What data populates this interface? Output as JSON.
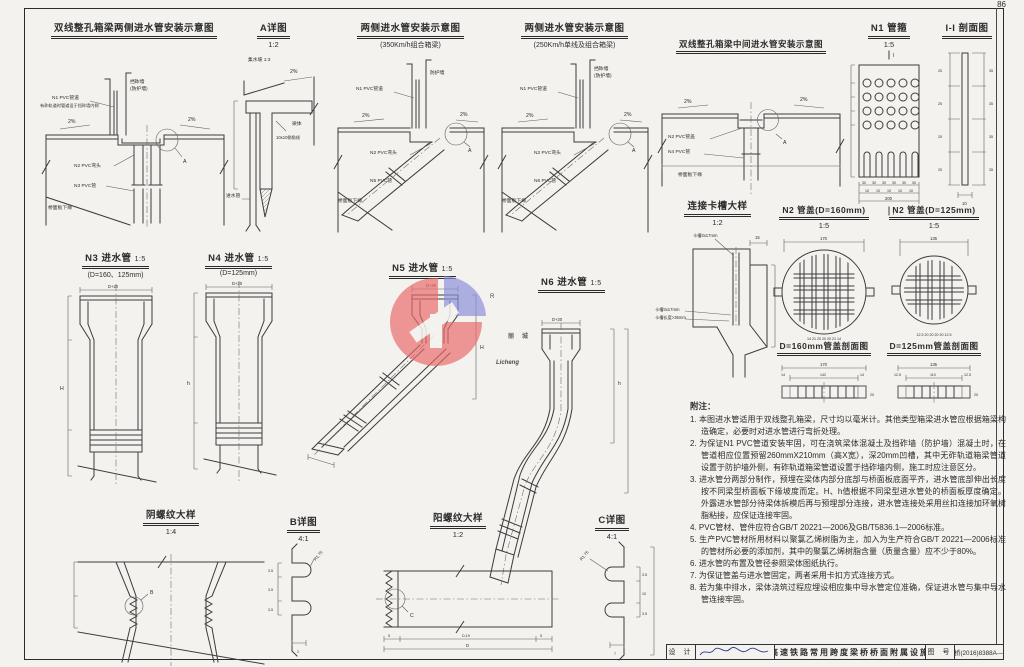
{
  "page": {
    "number": "86"
  },
  "watermark": {
    "cn": "丽城",
    "en": "Licheng",
    "reg": "R"
  },
  "d1": {
    "title": "双线整孔箱梁两侧进水管安装示意图",
    "wall1": "挡砟墙",
    "wall2": "(防护墙)",
    "n1": "N1 PVC管道",
    "n1sub": "有砟轨道时管道设于挡砟墙内侧",
    "slope": "2%",
    "n2": "N2 PVC弯头",
    "n3": "N3 PVC管",
    "deck": "桥面板下缘",
    "detail": "A"
  },
  "d2": {
    "title": "A详图",
    "scale": "1:2",
    "catch": "集水坡 1:3",
    "slope": "2%",
    "body": "梁体",
    "chamfer": "10x10倒角线",
    "inlet": "进水管"
  },
  "d3": {
    "title": "两侧进水管安装示意图",
    "sub": "(350Km/h组合箱梁)",
    "wall": "防护墙",
    "n1": "N1 PVC管道",
    "slope": "2%",
    "n2": "N2 PVC弯头",
    "n5": "N5 PVC管",
    "deck": "桥面板下缘",
    "detail": "A"
  },
  "d4": {
    "title": "两侧进水管安装示意图",
    "sub": "(250Km/h单线及组合箱梁)",
    "wall1": "挡砟墙",
    "wall2": "(防护墙)",
    "n1": "N1 PVC管道",
    "slope": "2%",
    "n2": "N2 PVC弯头",
    "n6": "N6 PVC管",
    "deck": "桥面板下缘",
    "detail": "A"
  },
  "d5": {
    "title": "双线整孔箱梁中间进水管安装示意图",
    "slope": "2%",
    "n2": "N2 PVC管盖",
    "n4": "N4 PVC管",
    "deck": "桥面板下缘",
    "detail": "A"
  },
  "d6": {
    "title": "N1 管箍",
    "scale": "1:5",
    "sect": "I",
    "dims_bottom": [
      "30",
      "30",
      "30",
      "30",
      "30",
      "30"
    ],
    "dims_small": [
      "10",
      "10",
      "10",
      "10",
      "10"
    ],
    "total": "200"
  },
  "d7": {
    "title": "I-I 剖面图",
    "dims_left": [
      "25",
      "25",
      "25",
      "25"
    ],
    "dims_right": [
      "35",
      "35",
      "35",
      "35"
    ],
    "dim_bottom": "10"
  },
  "d8": {
    "title": "连接卡槽大样",
    "scale": "1:2",
    "slot1": "卡槽3x17mm",
    "slot2": "卡槽3x17mm",
    "slot3": "卡槽长度>35mm",
    "dim_top": "15"
  },
  "d9": {
    "title": "N2 管盖(D=160mm)",
    "scale": "1:5",
    "dim": "170",
    "dims_bottom": "14 21 20 20 20 21 14"
  },
  "d10": {
    "title": "N2 管盖(D=125mm)",
    "scale": "1:5",
    "dim": "135",
    "dims_bottom": "12.5 20 20 20 20 12.5"
  },
  "d11": {
    "title": "D=160mm管盖剖面图",
    "total": "170",
    "inner": "142",
    "edge": "14",
    "side": "20"
  },
  "d12": {
    "title": "D=125mm管盖剖面图",
    "total": "135",
    "inner": "110",
    "edge": "12.5",
    "side": "20"
  },
  "d13": {
    "title": "N3 进水管",
    "scale": "1:5",
    "sub": "(D=160、125mm)",
    "dim_top": "D+20",
    "dim_h": "H"
  },
  "d14": {
    "title": "N4 进水管",
    "scale": "1:5",
    "sub": "(D=125mm)",
    "dim_top": "D+20",
    "dim_h": "h"
  },
  "d15": {
    "title": "N5 进水管",
    "scale": "1:5",
    "dim_top": "D+20",
    "dim_h": "H"
  },
  "d16": {
    "title": "N6 进水管",
    "scale": "1:5",
    "dim_top": "D+20",
    "dim_h": "h"
  },
  "d17": {
    "title": "阴螺纹大样",
    "scale": "1:4",
    "detail": "B"
  },
  "d18": {
    "title": "B详图",
    "scale": "4:1",
    "r": "R1.75",
    "dims": [
      "3.5",
      "3.5",
      "3.5"
    ],
    "b": "2"
  },
  "d19": {
    "title": "阳螺纹大样",
    "scale": "1:2",
    "detail": "C",
    "dims": {
      "end1": "5",
      "mid": "D-19",
      "end2": "5",
      "total": "D"
    }
  },
  "d20": {
    "title": "C详图",
    "scale": "4:1",
    "r": "R1.75",
    "dims": [
      "3.5",
      "10",
      "3.5"
    ],
    "b": "7"
  },
  "notes": {
    "title": "附注：",
    "items": [
      "1. 本图进水管适用于双线整孔箱梁，尺寸均以毫米计。其他类型箱梁进水管应根据箱梁构造确定，必要时对进水管进行弯折处理。",
      "2. 为保证N1 PVC管道安装牢固，可在浇筑梁体混凝土及挡砟墙（防护墙）混凝土时，在管道相应位置预留260mmX210mm（高X宽），深20mm凹槽，其中无砟轨道箱梁管道设置于防护墙外侧，有砟轨道箱梁管道设置于挡砟墙内侧，施工时应注意区分。",
      "3. 进水管分两部分制作，预埋在梁体内部分底部与桥面板底面平齐，进水管底部伸出长度按不同梁型桥面板下缘坡度而定。H、h值根据不同梁型进水管处的桥面板厚度确定。外露进水管部分待梁体拆模后再与预埋部分连接，进水管连接处采用丝扣连接加环氧树脂粘接，应保证连接牢固。",
      "4. PVC管材、管件应符合GB/T 20221—2006及GB/T5836.1—2006标准。",
      "5. 生产PVC管材所用材料以聚氯乙烯树脂为主，加入为生产符合GB/T 20221—2006标准的管材所必要的添加剂，其中的聚氯乙烯树脂含量（质量含量）应不少于80%。",
      "6. 进水管的布置及管径参照梁体图纸执行。",
      "7. 为保证管盖与进水管固定，两者采用卡扣方式连接方式。",
      "8. 若为集中排水，梁体浇筑过程应埋设相应集中导水管定位准确，保证进水管与集中导水管连接牢固。"
    ]
  },
  "titleblock": {
    "design": "设 计",
    "doc_title": "高速铁路常用跨度梁桥桥面附属设施",
    "fig_label": "图 号",
    "fig_no": "通桥(2016)8388A—86"
  }
}
